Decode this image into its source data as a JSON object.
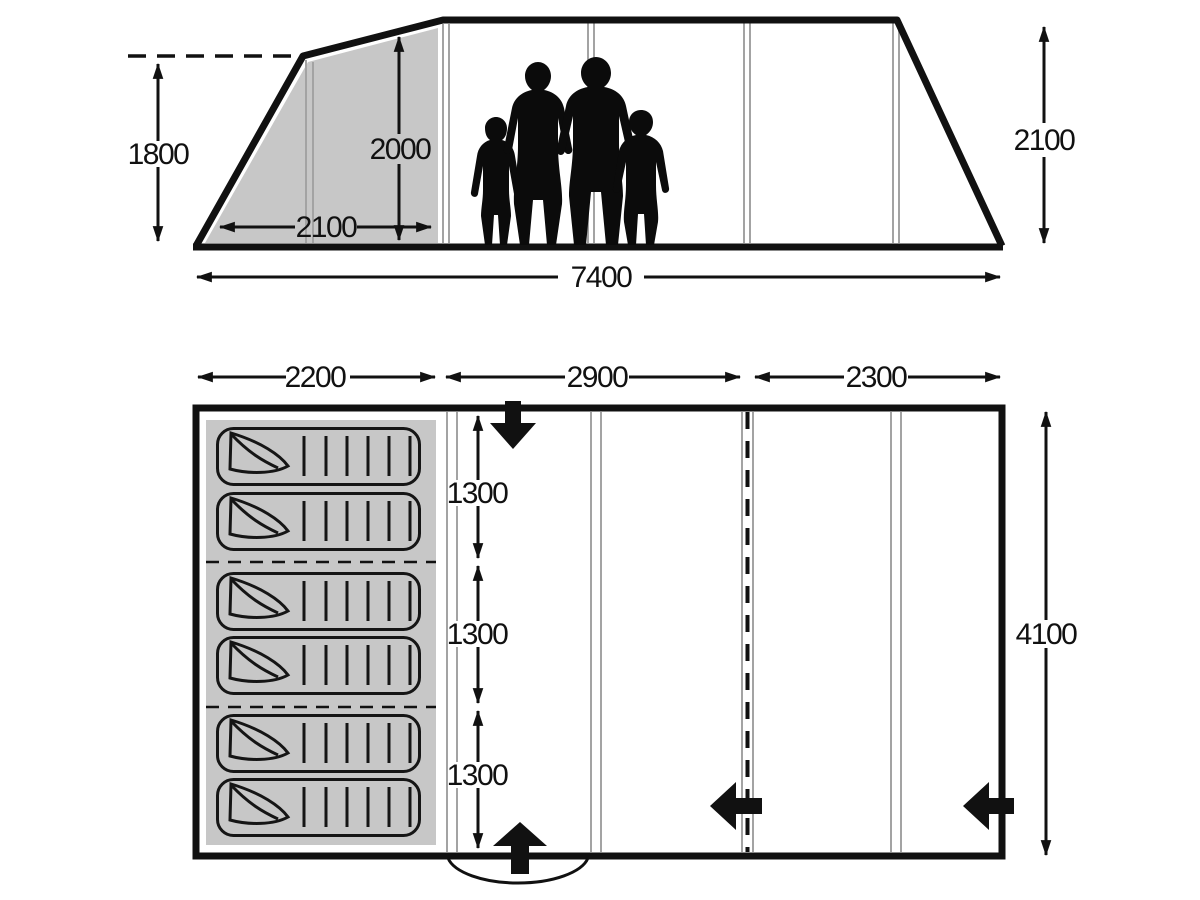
{
  "title": "Tent dimensions diagram",
  "colors": {
    "background": "#ffffff",
    "ink": "#111111",
    "panel_gray": "#c7c7c7",
    "frame_line_gray": "#a3a3a3"
  },
  "side_view": {
    "labels": {
      "front_height": "1800",
      "inner_height": "2000",
      "porch_depth": "2100",
      "max_height": "2100",
      "total_length": "7400"
    }
  },
  "floor_plan": {
    "labels": {
      "section_1_length": "2200",
      "section_2_length": "2900",
      "section_3_length": "2300",
      "berth_1_width": "1300",
      "berth_2_width": "1300",
      "berth_3_width": "1300",
      "total_width": "4100"
    },
    "sleeping_bag_count": 6
  },
  "icons": {
    "top_entrance": "arrow-down",
    "bottom_entrance": "arrow-up",
    "inner_door": "arrow-left",
    "side_door": "arrow-left",
    "door_swing": "arc",
    "people": "family-silhouette"
  }
}
